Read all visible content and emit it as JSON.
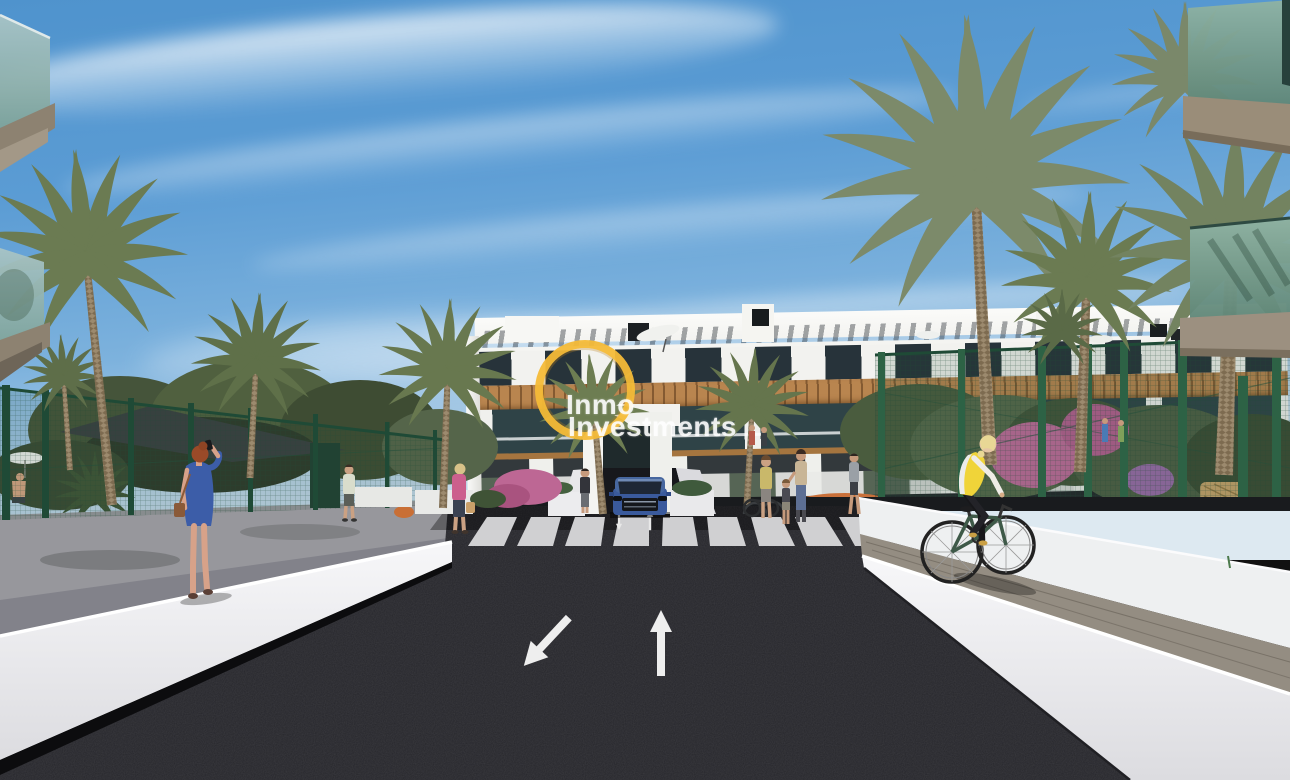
{
  "watermark": {
    "line1": "Inmo",
    "line2": "Investments",
    "ring_color": "#f4ba37",
    "text_color": "#ffffff"
  },
  "scene": {
    "type": "3d-architectural-render-street-view",
    "elements": [
      "sky-with-clouds",
      "white-apartment-building",
      "wood-pergola-band",
      "glass-balconies",
      "palm-trees",
      "green-mesh-fence",
      "shade-sail",
      "white-retaining-walls",
      "asphalt-road",
      "zebra-crosswalk",
      "road-arrows",
      "underground-parking-ramp",
      "blue-suv",
      "woman-on-phone",
      "cyclist-yellow-vest",
      "pedestrians",
      "garden-shrubs",
      "flowers"
    ],
    "palette": {
      "sky_blue": "#5b9cd4",
      "asphalt": "#26262b",
      "wall_white": "#f2f2f4",
      "wood_pergola": "#b9854f",
      "fence_green": "#2d6245",
      "palm_green": "#6d7d52",
      "car_blue": "#3a5a9c",
      "vest_yellow": "#f0d439",
      "dress_blue": "#3c5da8",
      "watermark_yellow": "#f4ba37"
    },
    "road_markings": {
      "crosswalk_stripes": 9,
      "arrows": [
        "toward-viewer",
        "away-from-viewer"
      ]
    },
    "counts": {
      "palm_trees": 11,
      "people_visible": 12
    }
  }
}
